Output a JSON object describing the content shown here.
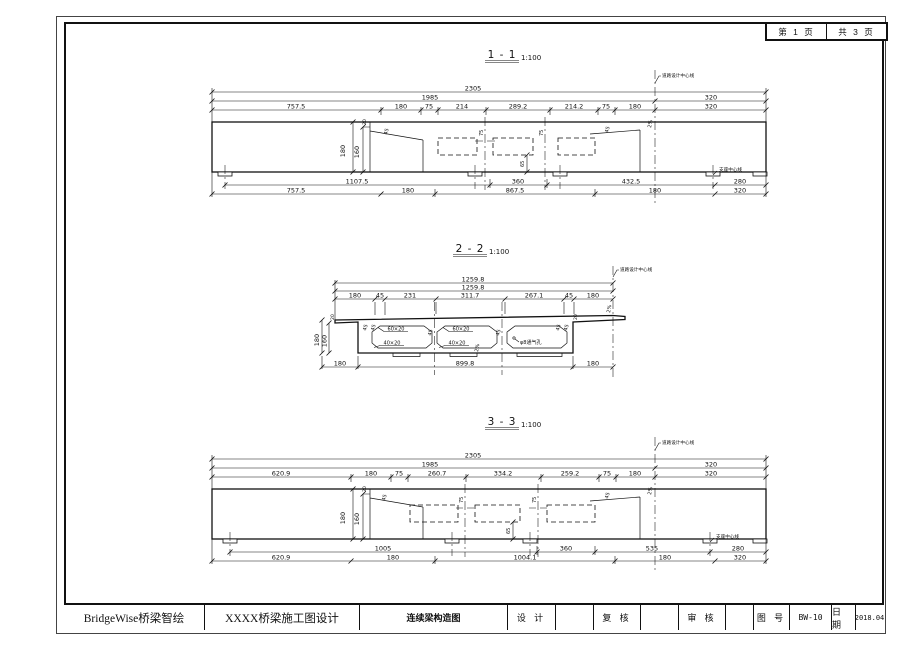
{
  "page": {
    "background": "#ffffff",
    "line_color": "#111111"
  },
  "header": {
    "page_current": "第 1 页",
    "page_total": "共 3 页"
  },
  "title_block": {
    "company": "BridgeWise桥梁智绘",
    "project": "XXXX桥梁施工图设计",
    "drawing_title": "连续梁构造图",
    "design_label": "设 计",
    "check_label": "复 核",
    "audit_label": "审 核",
    "sheet_no_label": "图 号",
    "sheet_no": "BW-10",
    "date_label": "日 期",
    "date": "2018.04"
  },
  "common": {
    "scale": "1:100",
    "road_centerline": "道路设计中心线",
    "bearing_centerline": "支座中心线",
    "angle_45": "45",
    "depth_180": "180",
    "depth_160": "160",
    "thk_20": "20",
    "dim_65": "65",
    "dim_75": "75",
    "slope_2pct": "2%"
  },
  "s11": {
    "title": "1 - 1",
    "dim_total": "2305",
    "dim_main": "1985",
    "dim_right": "320",
    "top_dims": [
      "757.5",
      "180",
      "75",
      "214",
      "289.2",
      "214.2",
      "75",
      "180"
    ],
    "bottom_dims_1": [
      "1107.5",
      "360",
      "432.5",
      "280"
    ],
    "bottom_dims_2": [
      "757.5",
      "180",
      "867.5",
      "180",
      "320"
    ]
  },
  "s22": {
    "title": "2 - 2",
    "dim_total_1": "1259.8",
    "dim_total_2": "1259.8",
    "top_dims": [
      "180",
      "45",
      "231",
      "311.7",
      "267.1",
      "45",
      "180"
    ],
    "bottom_dims": [
      "180",
      "899.8",
      "180"
    ],
    "chamfer_top": "60×20",
    "chamfer_bottom": "40×20",
    "vent_label": "φ8通气孔"
  },
  "s33": {
    "title": "3 - 3",
    "dim_total": "2305",
    "dim_main": "1985",
    "dim_right": "320",
    "top_dims": [
      "620.9",
      "180",
      "75",
      "260.7",
      "334.2",
      "259.2",
      "75",
      "180"
    ],
    "bottom_dims_1": [
      "1005",
      "360",
      "535",
      "280"
    ],
    "bottom_dims_2": [
      "620.9",
      "180",
      "1004.1",
      "180",
      "320"
    ]
  }
}
